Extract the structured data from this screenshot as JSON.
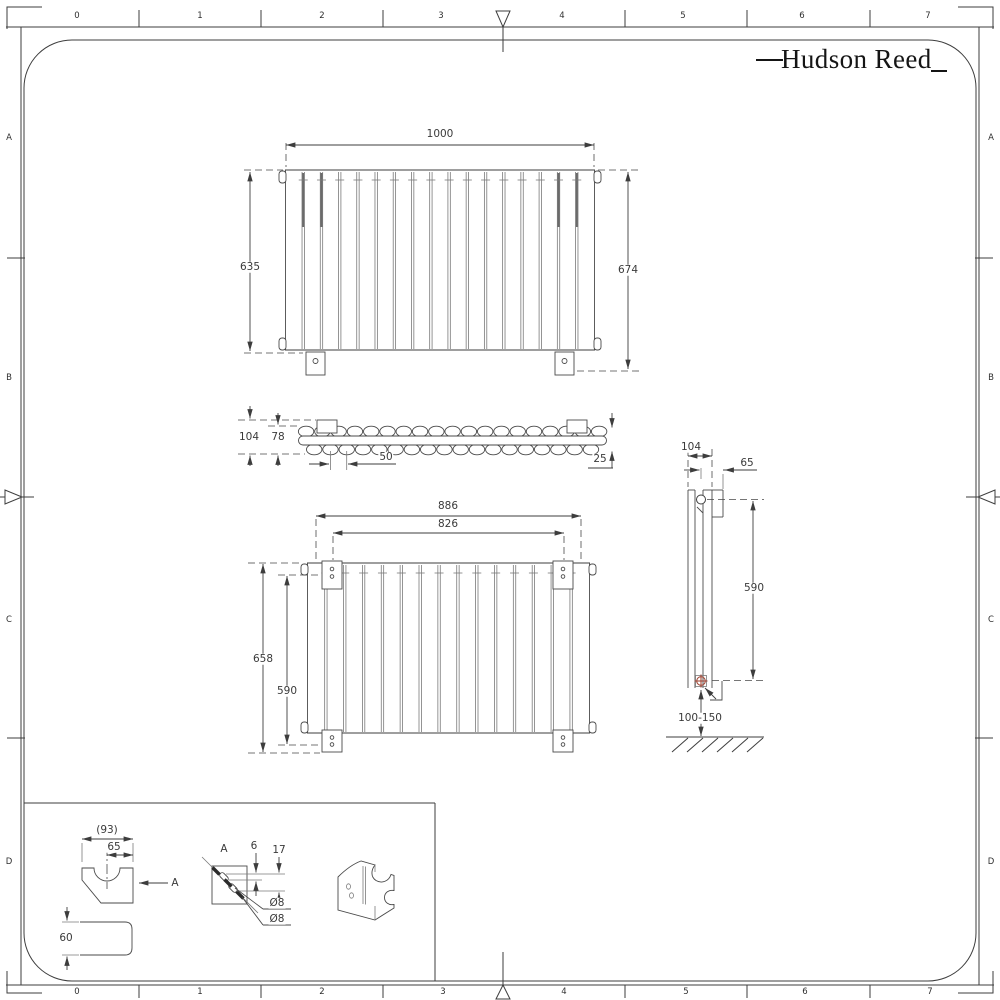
{
  "logo": {
    "text": "Hudson Reed"
  },
  "ruler": {
    "top": [
      "0",
      "1",
      "2",
      "3",
      "4",
      "5",
      "6",
      "7"
    ],
    "bottom": [
      "0",
      "1",
      "2",
      "3",
      "4",
      "5",
      "6",
      "7"
    ],
    "left": [
      "A",
      "B",
      "C",
      "D"
    ],
    "right": [
      "A",
      "B",
      "C",
      "D"
    ]
  },
  "dims": {
    "front1000": {
      "width": "1000",
      "height_left": "635",
      "height_right": "674"
    },
    "topview": {
      "overall_depth": "104",
      "core_depth": "78",
      "tube_pitch": "50",
      "edge_offset": "25"
    },
    "front886": {
      "width": "886",
      "bracket_span": "826",
      "height": "658",
      "bracket_height": "590"
    },
    "sideview": {
      "depth": "104",
      "bracket_offset": "65",
      "bracket_height": "590",
      "floor_clearance": "100-150"
    },
    "bracket": {
      "width_ref": "(93)",
      "center_offset": "65",
      "depth": "60",
      "view_label": "A",
      "section_label": "A",
      "slot_width": "6",
      "slot_spacing": "17",
      "hole_dia_1": "Ø8",
      "hole_dia_2": "Ø8"
    }
  },
  "colors": {
    "line": "#3d3d3d",
    "light_line": "#7a7a7a",
    "accent": "#a14a3a",
    "background": "#ffffff"
  },
  "drawing": {
    "front_1000": {
      "x": 285,
      "x2": 595,
      "top": 170,
      "bottom": 350,
      "panels": 17
    },
    "front_886": {
      "x": 307,
      "x2": 590,
      "top": 563,
      "bottom": 733,
      "panels": 15
    },
    "top_view": {
      "x": 298,
      "tubes_top": 19,
      "tubes_bottom": 18,
      "pitch": 16.28,
      "cy_top": 431.5,
      "cy_bottom": 449.5
    },
    "bracket_strips_x": [
      303.2,
      321.5,
      558.5,
      576.8
    ],
    "ruler_ticks_x": [
      139,
      261,
      383,
      625,
      747,
      870
    ],
    "side_ticks_y": [
      258,
      738
    ],
    "hatch": {
      "x": 668,
      "y": 737,
      "count": 6,
      "step": 15
    }
  }
}
